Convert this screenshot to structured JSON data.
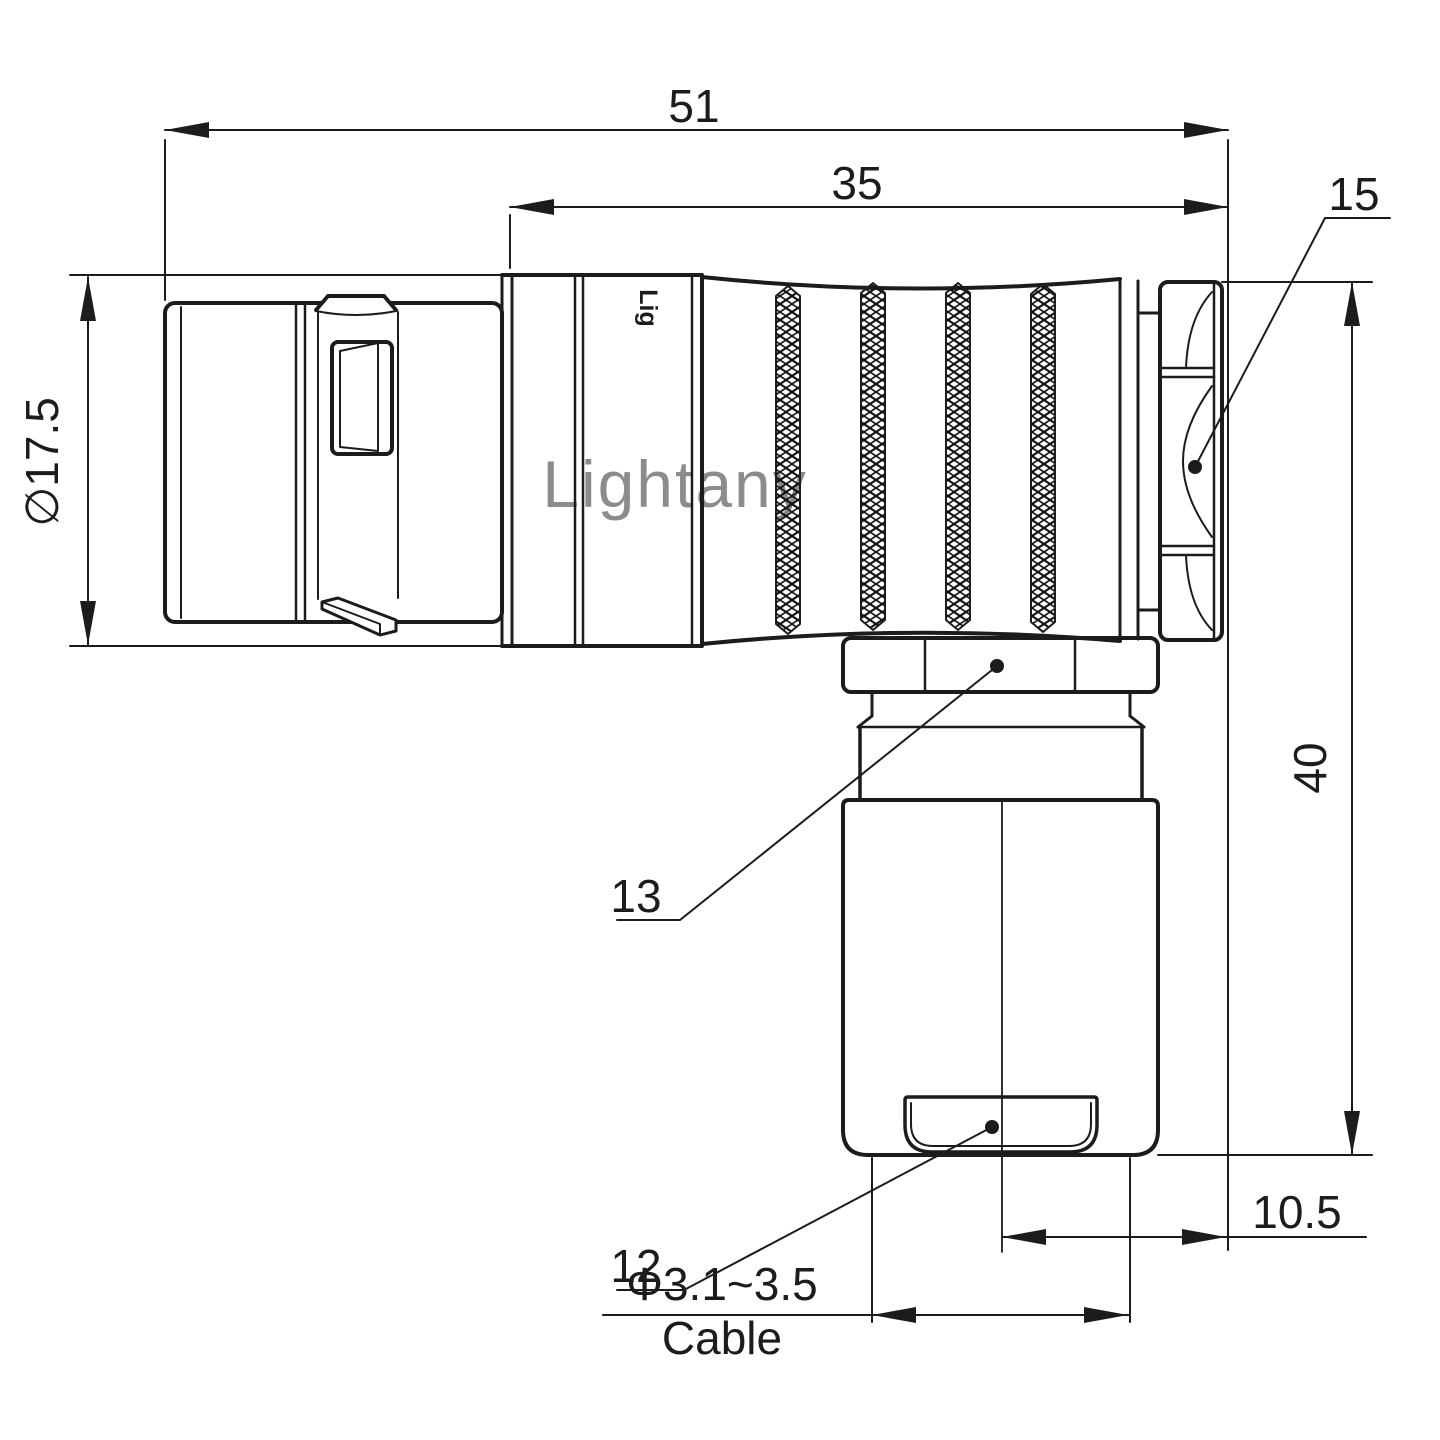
{
  "drawing": {
    "title": "Right-angle connector dimensioned drawing",
    "line_color": "#1c1c1c",
    "watermark": {
      "text": "Lightany",
      "color": "#eeb4b4"
    },
    "engraving": {
      "text": "Lig"
    },
    "dimensions": {
      "overall_length": {
        "value": "51"
      },
      "rear_length": {
        "value": "35"
      },
      "coupling_diameter": {
        "value": "∅17.5"
      },
      "overall_height": {
        "value": "40"
      },
      "exit_offset": {
        "value": "10.5"
      },
      "cable_range": {
        "value": "Φ3.1~3.5"
      },
      "cable_label": {
        "value": "Cable"
      }
    },
    "parts": {
      "hex_nut": {
        "number": "15"
      },
      "gland_nut": {
        "number": "13"
      },
      "cable_cap": {
        "number": "12"
      }
    }
  }
}
